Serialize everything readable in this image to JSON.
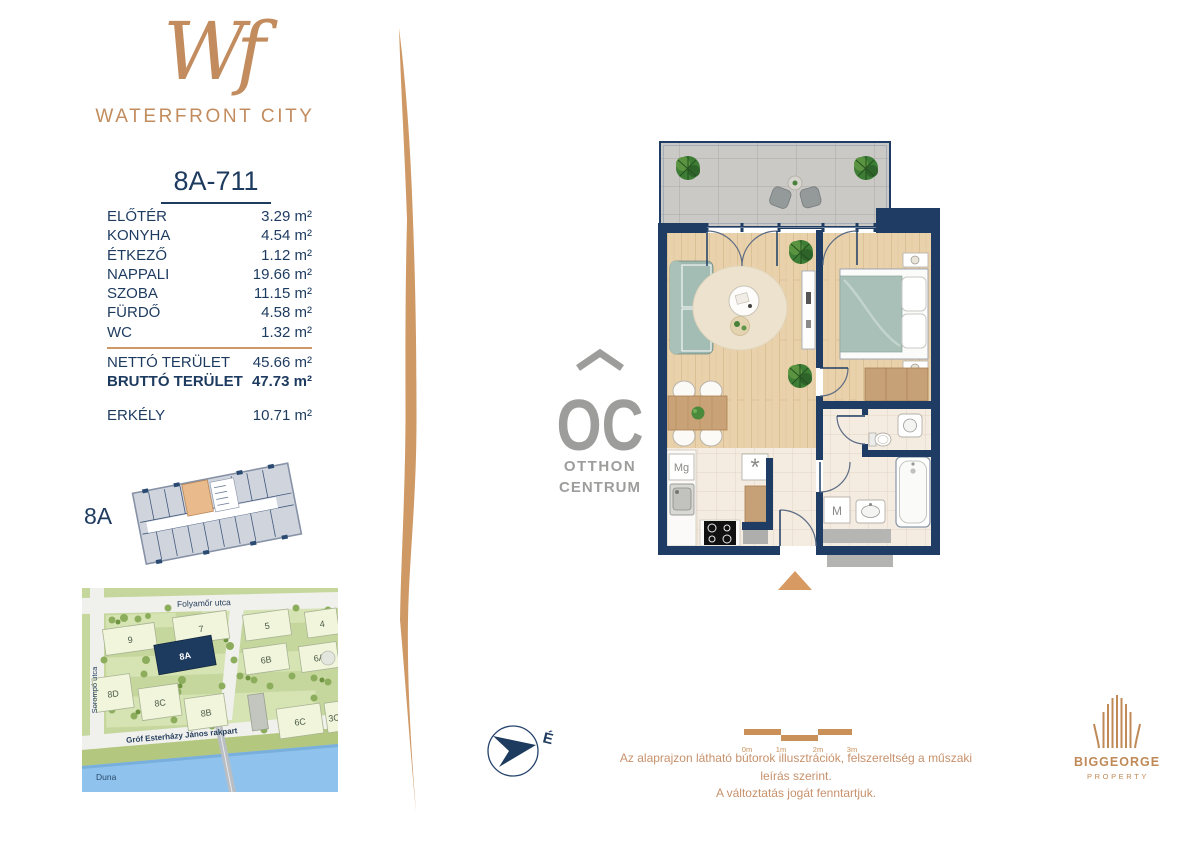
{
  "brand": {
    "monogram": "Wf",
    "name": "WATERFRONT CITY"
  },
  "unit_title": "8A-711",
  "area_table": {
    "rooms": [
      {
        "name": "ELŐTÉR",
        "value": "3.29 m²"
      },
      {
        "name": "KONYHA",
        "value": "4.54 m²"
      },
      {
        "name": "ÉTKEZŐ",
        "value": "1.12 m²"
      },
      {
        "name": "NAPPALI",
        "value": "19.66 m²"
      },
      {
        "name": "SZOBA",
        "value": "11.15 m²"
      },
      {
        "name": "FÜRDŐ",
        "value": "4.58 m²"
      },
      {
        "name": "WC",
        "value": "1.32 m²"
      }
    ],
    "net": {
      "name": "NETTÓ TERÜLET",
      "value": "45.66 m²"
    },
    "gross": {
      "name": "BRUTTÓ TERÜLET",
      "value": "47.73 m²"
    },
    "balcony": {
      "name": "ERKÉLY",
      "value": "10.71 m²"
    }
  },
  "keyplan": {
    "label": "8A"
  },
  "map": {
    "streets": {
      "top": "Folyamőr utca",
      "left": "Sorompó utca",
      "embankment": "Gróf Esterházy János rakpart",
      "river": "Duna"
    },
    "buildings": [
      {
        "label": "9"
      },
      {
        "label": "7"
      },
      {
        "label": "5"
      },
      {
        "label": "4"
      },
      {
        "label": "8A"
      },
      {
        "label": "6B"
      },
      {
        "label": "6A"
      },
      {
        "label": "8D"
      },
      {
        "label": "8C"
      },
      {
        "label": "8B"
      },
      {
        "label": "6C"
      },
      {
        "label": "3C"
      }
    ]
  },
  "floorplan": {
    "appliances": {
      "fridge": "Mg",
      "dishwasher": "*",
      "washer": "M"
    }
  },
  "compass": {
    "north": "É"
  },
  "scalebar": {
    "ticks": [
      "0m",
      "1m",
      "2m",
      "3m"
    ]
  },
  "disclaimer": {
    "line1": "Az alaprajzon látható bútorok illusztrációk, felszereltség a műszaki leírás szerint.",
    "line2": "A változtatás jogát fenntartjuk."
  },
  "oc_logo": {
    "monogram": "OC",
    "line1": "OTTHON",
    "line2": "CENTRUM"
  },
  "developer": {
    "name": "BIGGEORGE",
    "sub": "PROPERTY"
  },
  "colors": {
    "navy": "#1d3a5f",
    "copper": "#c28c5e",
    "sage": "#a9c0b8",
    "river_blue": "#8fc2ec"
  }
}
